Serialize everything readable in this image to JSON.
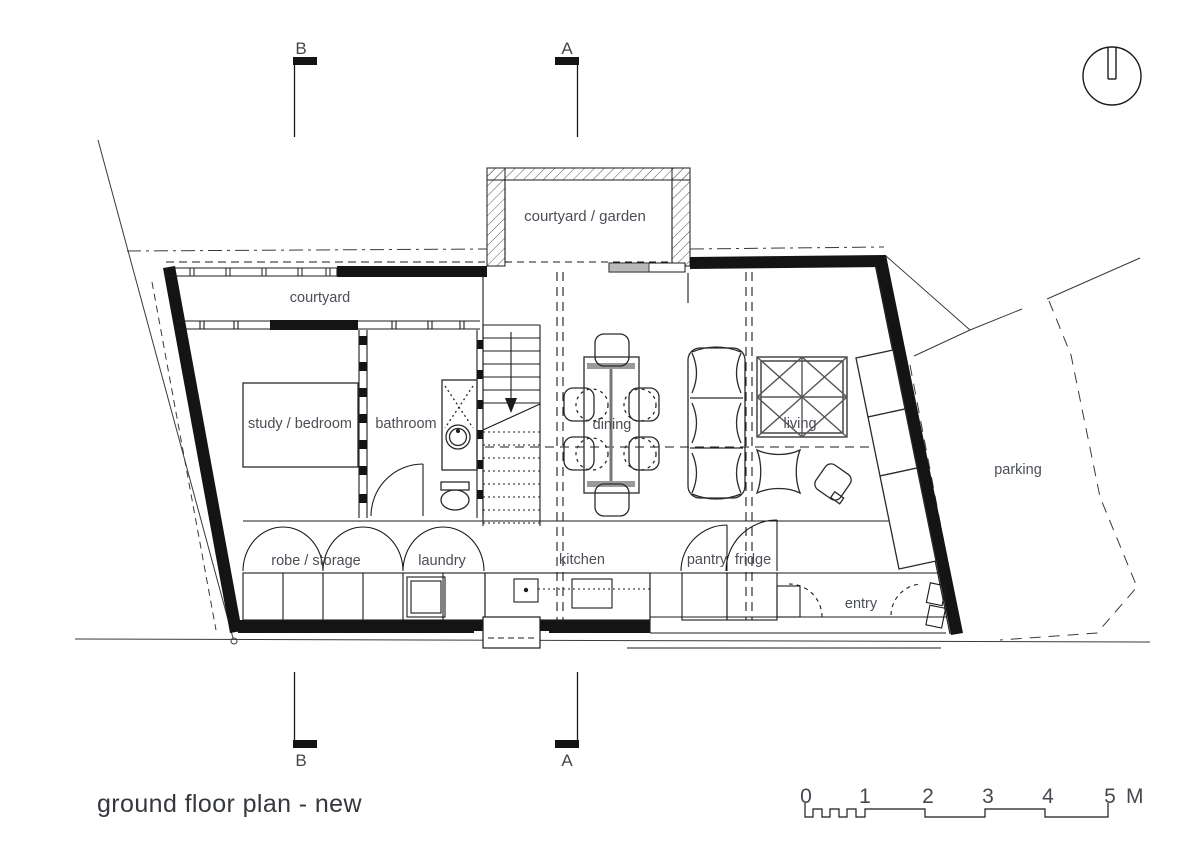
{
  "drawing": {
    "title": "ground floor plan - new"
  },
  "sections": {
    "a": "A",
    "b": "B"
  },
  "rooms": {
    "courtyard_garden": "courtyard / garden",
    "courtyard": "courtyard",
    "study_bedroom": "study / bedroom",
    "bathroom": "bathroom",
    "dining": "dining",
    "living": "living",
    "robe_storage": "robe / storage",
    "laundry": "laundry",
    "kitchen": "kitchen",
    "pantry": "pantry",
    "fridge": "fridge",
    "entry": "entry",
    "parking": "parking"
  },
  "scale": {
    "t0": "0",
    "t1": "1",
    "t2": "2",
    "t3": "3",
    "t4": "4",
    "t5": "5",
    "unit": "M"
  },
  "colors": {
    "line": "#1b1b1b",
    "wall": "#141414",
    "label": "#4a4e55",
    "title": "#34383d",
    "background": "#ffffff"
  }
}
